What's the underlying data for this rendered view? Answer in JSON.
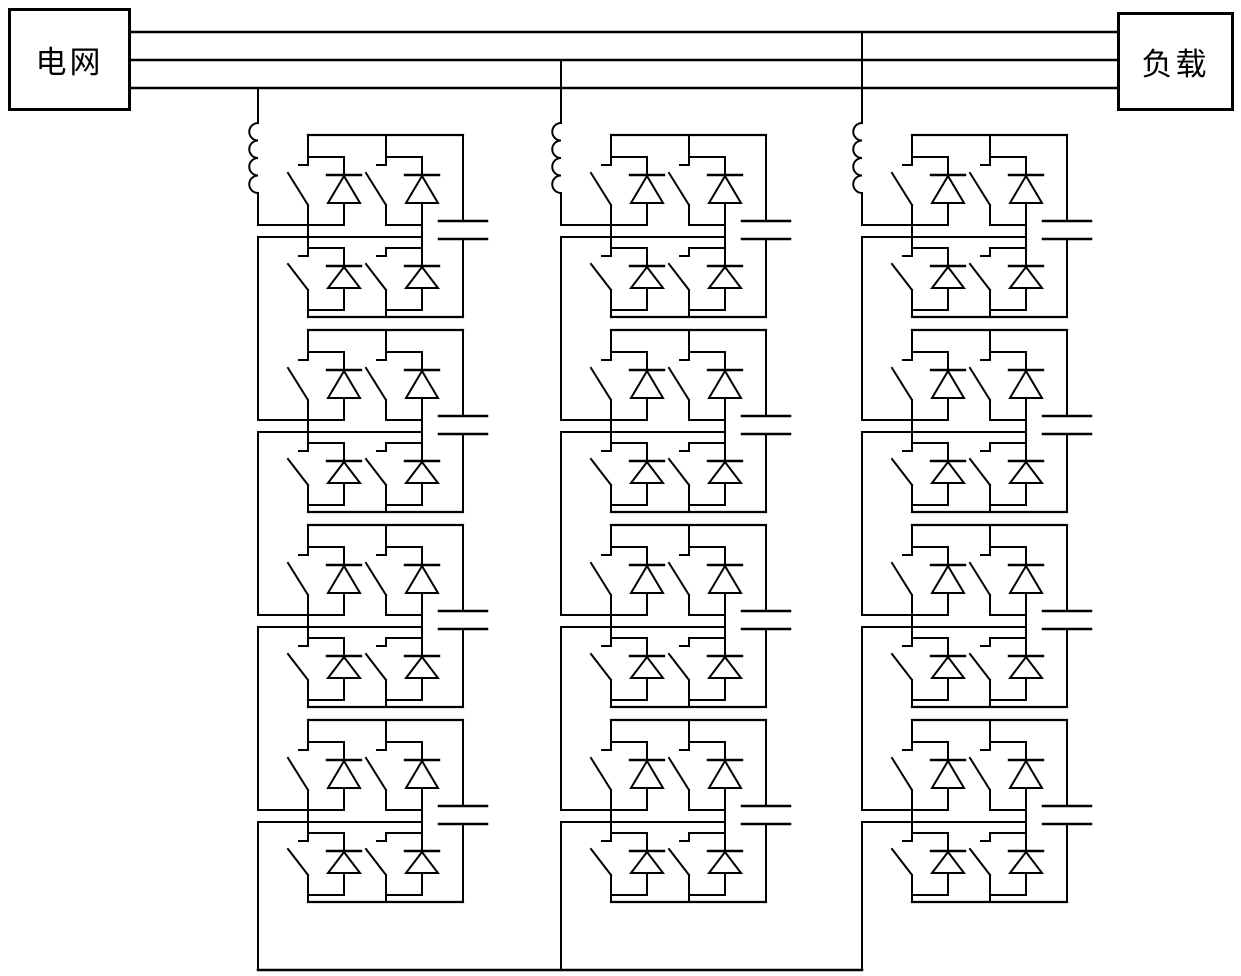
{
  "diagram": {
    "grid_label": "电网",
    "load_label": "负载",
    "line_color": "#000000",
    "background_color": "#ffffff",
    "structure": {
      "bus_lines": 3,
      "phase_legs": 3,
      "cells_per_leg": 4,
      "switch_diode_pairs_per_cell": 4,
      "capacitors_per_cell": 1,
      "inductors_per_leg": 1
    }
  }
}
